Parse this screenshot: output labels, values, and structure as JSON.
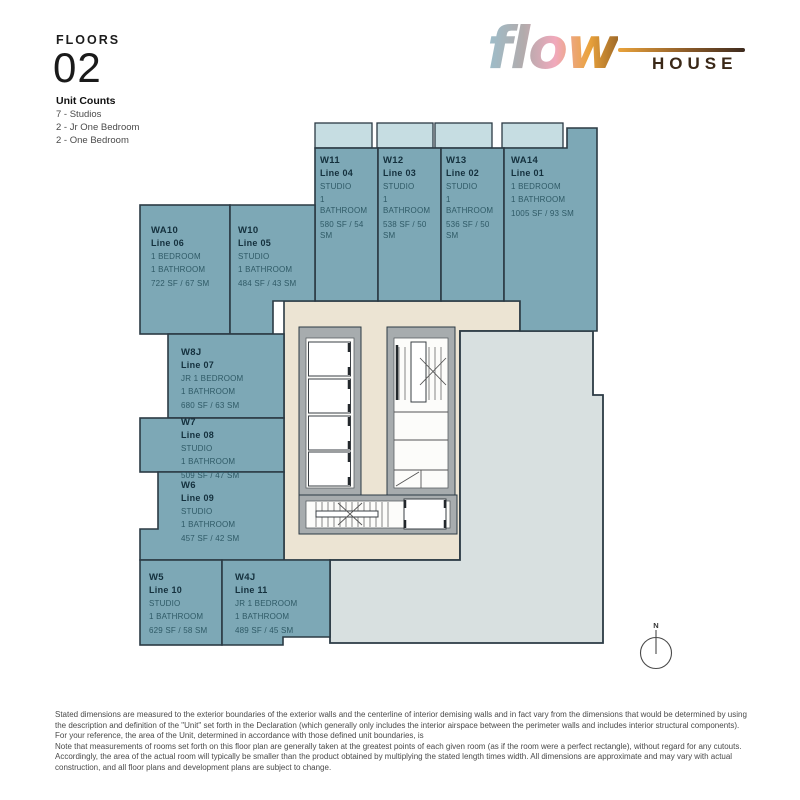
{
  "colors": {
    "unit_fill": "#7da8b6",
    "balcony_fill": "#c6dde2",
    "corridor_fill": "#ece4d3",
    "open_area_fill": "#d8e0e0",
    "wall_stroke": "#2b3a44",
    "core_wall_fill": "#a7acae",
    "logo_house_color": "#3a2817",
    "logo_gradient": [
      "#9cbecb",
      "#b2abac",
      "#f0a9bc",
      "#eaa33b"
    ]
  },
  "header": {
    "floors_label": "FLOORS",
    "floor_number": "02",
    "unit_counts_title": "Unit Counts",
    "unit_counts": [
      "7 - Studios",
      "2 - Jr One Bedroom",
      "2 - One Bedroom"
    ]
  },
  "logo": {
    "script_word": "flow",
    "block_word": "HOUSE"
  },
  "plan": {
    "north_label": "N",
    "units": [
      {
        "id": "W11",
        "line": "Line 04",
        "type": "STUDIO",
        "bath": "1 BATHROOM",
        "area": "580 SF / 54 SM"
      },
      {
        "id": "W12",
        "line": "Line 03",
        "type": "STUDIO",
        "bath": "1 BATHROOM",
        "area": "538 SF / 50 SM"
      },
      {
        "id": "W13",
        "line": "Line 02",
        "type": "STUDIO",
        "bath": "1 BATHROOM",
        "area": "536 SF / 50 SM"
      },
      {
        "id": "WA14",
        "line": "Line 01",
        "type": "1 BEDROOM",
        "bath": "1 BATHROOM",
        "area": "1005 SF / 93 SM"
      },
      {
        "id": "WA10",
        "line": "Line 06",
        "type": "1 BEDROOM",
        "bath": "1 BATHROOM",
        "area": "722 SF / 67 SM"
      },
      {
        "id": "W10",
        "line": "Line 05",
        "type": "STUDIO",
        "bath": "1 BATHROOM",
        "area": "484 SF / 43 SM"
      },
      {
        "id": "W8J",
        "line": "Line 07",
        "type": "JR 1 BEDROOM",
        "bath": "1 BATHROOM",
        "area": "680 SF / 63 SM"
      },
      {
        "id": "W7",
        "line": "Line 08",
        "type": "STUDIO",
        "bath": "1 BATHROOM",
        "area": "509 SF / 47 SM"
      },
      {
        "id": "W6",
        "line": "Line 09",
        "type": "STUDIO",
        "bath": "1 BATHROOM",
        "area": "457 SF / 42 SM"
      },
      {
        "id": "W5",
        "line": "Line 10",
        "type": "STUDIO",
        "bath": "1 BATHROOM",
        "area": "629 SF / 58 SM"
      },
      {
        "id": "W4J",
        "line": "Line 11",
        "type": "JR 1 BEDROOM",
        "bath": "1 BATHROOM",
        "area": "489 SF / 45 SM"
      }
    ]
  },
  "footer": {
    "para1": "Stated dimensions are measured to the exterior boundaries of the exterior walls and the centerline of interior demising walls and in fact vary from the dimensions that would be determined by using the description and definition of the \"Unit\" set forth in the Declaration (which generally only includes the interior airspace between the perimeter walls  and includes interior structural components).  For your reference, the area of the Unit, determined in accordance with those defined unit boundaries, is",
    "para2": "Note that measurements of rooms set forth on this floor plan are generally taken at the greatest points of each given room (as if the room were a perfect rectangle), without regard for any cutouts.  Accordingly, the area of the actual room will typically be smaller than the product obtained by multiplying the stated length times width.  All dimensions are approximate and may vary with actual construction, and all floor plans and development plans are subject to change."
  }
}
